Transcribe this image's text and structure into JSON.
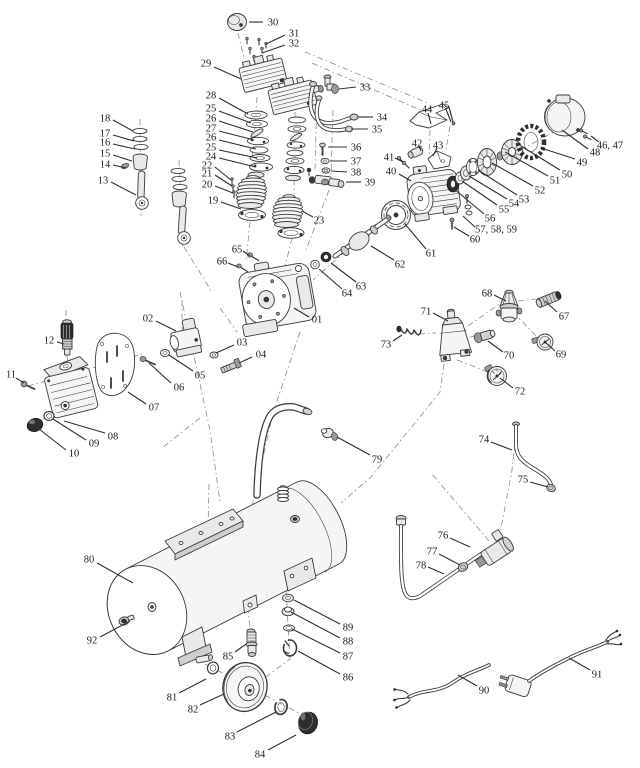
{
  "diagram": {
    "background": "#ffffff",
    "line_color": "#3a3a3a",
    "label_color": "#1b1b1b",
    "leader_color": "#2f2f2f",
    "dash_color": "#8a8a8a"
  },
  "callouts": [
    {
      "t": "01",
      "x": 317,
      "y": 319,
      "l": [
        309,
        317,
        294,
        308
      ]
    },
    {
      "t": "02",
      "x": 148,
      "y": 318,
      "l": [
        156,
        321,
        176,
        331
      ]
    },
    {
      "t": "03",
      "x": 242,
      "y": 342,
      "l": [
        234,
        345,
        216,
        353
      ]
    },
    {
      "t": "04",
      "x": 261,
      "y": 354,
      "l": [
        252,
        357,
        239,
        363
      ]
    },
    {
      "t": "05",
      "x": 200,
      "y": 375,
      "l": [
        193,
        371,
        169,
        355
      ]
    },
    {
      "t": "06",
      "x": 179,
      "y": 387,
      "l": [
        171,
        383,
        149,
        363
      ]
    },
    {
      "t": "07",
      "x": 154,
      "y": 407,
      "l": [
        146,
        404,
        128,
        392
      ]
    },
    {
      "t": "08",
      "x": 113,
      "y": 436,
      "l": [
        105,
        433,
        64,
        421
      ]
    },
    {
      "t": "09",
      "x": 94,
      "y": 443,
      "l": [
        86,
        440,
        53,
        419
      ]
    },
    {
      "t": "10",
      "x": 74,
      "y": 453,
      "l": [
        66,
        450,
        39,
        429
      ]
    },
    {
      "t": "11",
      "x": 11,
      "y": 374,
      "l": [
        16,
        378,
        24,
        383
      ]
    },
    {
      "t": "12",
      "x": 49,
      "y": 340,
      "l": [
        57,
        342,
        64,
        344
      ]
    },
    {
      "t": "13",
      "x": 103,
      "y": 180,
      "l": [
        111,
        182,
        136,
        195
      ]
    },
    {
      "t": "14",
      "x": 105,
      "y": 164,
      "l": [
        113,
        165,
        126,
        168
      ]
    },
    {
      "t": "15",
      "x": 105,
      "y": 153,
      "l": [
        113,
        155,
        132,
        161
      ]
    },
    {
      "t": "16",
      "x": 105,
      "y": 142,
      "l": [
        113,
        144,
        135,
        149
      ]
    },
    {
      "t": "17",
      "x": 105,
      "y": 133,
      "l": [
        113,
        135,
        134,
        141
      ]
    },
    {
      "t": "18",
      "x": 105,
      "y": 118,
      "l": [
        113,
        120,
        133,
        131
      ]
    },
    {
      "t": "19",
      "x": 213,
      "y": 200,
      "l": [
        221,
        202,
        241,
        209
      ]
    },
    {
      "t": "20",
      "x": 207,
      "y": 184,
      "l": [
        215,
        186,
        233,
        193
      ]
    },
    {
      "t": "21",
      "x": 207,
      "y": 173,
      "l": [
        215,
        175,
        232,
        186
      ]
    },
    {
      "t": "22",
      "x": 207,
      "y": 165,
      "l": [
        215,
        167,
        231,
        180
      ]
    },
    {
      "t": "23",
      "x": 319,
      "y": 220,
      "l": [
        313,
        217,
        302,
        211
      ]
    },
    {
      "t": "24",
      "x": 211,
      "y": 156,
      "l": [
        219,
        158,
        256,
        167
      ]
    },
    {
      "t": "25",
      "x": 211,
      "y": 108,
      "l": [
        219,
        111,
        251,
        123
      ]
    },
    {
      "t": "26",
      "x": 211,
      "y": 118,
      "l": [
        219,
        121,
        253,
        132
      ]
    },
    {
      "t": "27",
      "x": 211,
      "y": 128,
      "l": [
        219,
        131,
        254,
        140
      ]
    },
    {
      "t": "26",
      "x": 211,
      "y": 137,
      "l": [
        219,
        140,
        256,
        149
      ]
    },
    {
      "t": "25",
      "x": 211,
      "y": 147,
      "l": [
        219,
        150,
        257,
        158
      ]
    },
    {
      "t": "28",
      "x": 211,
      "y": 95,
      "l": [
        219,
        98,
        248,
        114
      ]
    },
    {
      "t": "29",
      "x": 206,
      "y": 63,
      "l": [
        214,
        67,
        241,
        79
      ]
    },
    {
      "t": "30",
      "x": 273,
      "y": 22,
      "l": [
        263,
        22,
        249,
        22
      ]
    },
    {
      "t": "31",
      "x": 294,
      "y": 33,
      "l": [
        285,
        35,
        266,
        44
      ]
    },
    {
      "t": "32",
      "x": 294,
      "y": 43,
      "l": [
        285,
        45,
        262,
        53
      ]
    },
    {
      "t": "33",
      "x": 365,
      "y": 87,
      "l": [
        356,
        87,
        339,
        89
      ]
    },
    {
      "t": "34",
      "x": 382,
      "y": 117,
      "l": [
        373,
        117,
        358,
        117
      ]
    },
    {
      "t": "35",
      "x": 377,
      "y": 129,
      "l": [
        368,
        129,
        351,
        129
      ]
    },
    {
      "t": "36",
      "x": 356,
      "y": 147,
      "l": [
        347,
        147,
        328,
        147
      ]
    },
    {
      "t": "37",
      "x": 356,
      "y": 161,
      "l": [
        347,
        161,
        330,
        161
      ]
    },
    {
      "t": "38",
      "x": 356,
      "y": 172,
      "l": [
        347,
        172,
        331,
        171
      ]
    },
    {
      "t": "39",
      "x": 370,
      "y": 182,
      "l": [
        361,
        182,
        346,
        182
      ]
    },
    {
      "t": "40",
      "x": 391,
      "y": 171,
      "l": [
        399,
        174,
        411,
        181
      ]
    },
    {
      "t": "41",
      "x": 389,
      "y": 157,
      "l": [
        395,
        158,
        403,
        162
      ]
    },
    {
      "t": "42",
      "x": 417,
      "y": 143,
      "l": [
        419,
        146,
        421,
        151
      ]
    },
    {
      "t": "43",
      "x": 438,
      "y": 145,
      "l": [
        437,
        148,
        433,
        156
      ]
    },
    {
      "t": "44",
      "x": 427,
      "y": 109,
      "l": [
        428,
        113,
        431,
        124
      ]
    },
    {
      "t": "45",
      "x": 444,
      "y": 105,
      "l": [
        446,
        109,
        451,
        122
      ]
    },
    {
      "t": "46, 47",
      "x": 610,
      "y": 145,
      "l": [
        599,
        142,
        591,
        136
      ]
    },
    {
      "t": "48",
      "x": 595,
      "y": 152,
      "l": [
        588,
        149,
        562,
        130
      ]
    },
    {
      "t": "49",
      "x": 582,
      "y": 162,
      "l": [
        575,
        159,
        541,
        148
      ]
    },
    {
      "t": "50",
      "x": 567,
      "y": 174,
      "l": [
        560,
        170,
        521,
        146
      ]
    },
    {
      "t": "51",
      "x": 555,
      "y": 180,
      "l": [
        548,
        176,
        505,
        152
      ]
    },
    {
      "t": "52",
      "x": 540,
      "y": 190,
      "l": [
        533,
        186,
        492,
        163
      ]
    },
    {
      "t": "53",
      "x": 524,
      "y": 199,
      "l": [
        517,
        195,
        478,
        170
      ]
    },
    {
      "t": "54",
      "x": 514,
      "y": 203,
      "l": [
        507,
        199,
        469,
        176
      ]
    },
    {
      "t": "55",
      "x": 504,
      "y": 209,
      "l": [
        497,
        205,
        462,
        181
      ]
    },
    {
      "t": "56",
      "x": 490,
      "y": 218,
      "l": [
        484,
        214,
        453,
        188
      ]
    },
    {
      "t": "57, 58, 59",
      "x": 496,
      "y": 229,
      "l": [
        475,
        227,
        463,
        216
      ]
    },
    {
      "t": "60",
      "x": 475,
      "y": 239,
      "l": [
        469,
        236,
        454,
        227
      ]
    },
    {
      "t": "61",
      "x": 431,
      "y": 253,
      "l": [
        426,
        249,
        405,
        224
      ]
    },
    {
      "t": "62",
      "x": 400,
      "y": 264,
      "l": [
        394,
        260,
        371,
        246
      ]
    },
    {
      "t": "63",
      "x": 361,
      "y": 286,
      "l": [
        356,
        282,
        331,
        263
      ]
    },
    {
      "t": "64",
      "x": 347,
      "y": 293,
      "l": [
        342,
        289,
        319,
        269
      ]
    },
    {
      "t": "65",
      "x": 237,
      "y": 249,
      "l": [
        243,
        251,
        250,
        256
      ]
    },
    {
      "t": "66",
      "x": 222,
      "y": 261,
      "l": [
        228,
        263,
        238,
        267
      ]
    },
    {
      "t": "67",
      "x": 564,
      "y": 316,
      "l": [
        557,
        312,
        545,
        301
      ]
    },
    {
      "t": "68",
      "x": 487,
      "y": 293,
      "l": [
        494,
        295,
        506,
        301
      ]
    },
    {
      "t": "69",
      "x": 561,
      "y": 354,
      "l": [
        555,
        351,
        545,
        342
      ]
    },
    {
      "t": "70",
      "x": 509,
      "y": 355,
      "l": [
        503,
        352,
        488,
        341
      ]
    },
    {
      "t": "71",
      "x": 426,
      "y": 311,
      "l": [
        433,
        313,
        448,
        321
      ]
    },
    {
      "t": "72",
      "x": 520,
      "y": 391,
      "l": [
        513,
        388,
        500,
        378
      ]
    },
    {
      "t": "73",
      "x": 386,
      "y": 344,
      "l": [
        393,
        341,
        402,
        335
      ]
    },
    {
      "t": "74",
      "x": 484,
      "y": 439,
      "l": [
        491,
        442,
        512,
        450
      ]
    },
    {
      "t": "75",
      "x": 523,
      "y": 479,
      "l": [
        530,
        482,
        548,
        487
      ]
    },
    {
      "t": "76",
      "x": 443,
      "y": 535,
      "l": [
        450,
        538,
        470,
        547
      ]
    },
    {
      "t": "77",
      "x": 432,
      "y": 551,
      "l": [
        439,
        554,
        460,
        565
      ]
    },
    {
      "t": "78",
      "x": 421,
      "y": 565,
      "l": [
        428,
        567,
        444,
        574
      ]
    },
    {
      "t": "79",
      "x": 377,
      "y": 459,
      "l": [
        370,
        455,
        337,
        437
      ]
    },
    {
      "t": "80",
      "x": 89,
      "y": 559,
      "l": [
        97,
        563,
        133,
        583
      ]
    },
    {
      "t": "81",
      "x": 172,
      "y": 697,
      "l": [
        179,
        693,
        206,
        679
      ]
    },
    {
      "t": "82",
      "x": 193,
      "y": 709,
      "l": [
        200,
        705,
        224,
        694
      ]
    },
    {
      "t": "83",
      "x": 230,
      "y": 736,
      "l": [
        237,
        732,
        276,
        712
      ]
    },
    {
      "t": "84",
      "x": 260,
      "y": 754,
      "l": [
        268,
        750,
        296,
        735
      ]
    },
    {
      "t": "85",
      "x": 228,
      "y": 656,
      "l": [
        235,
        652,
        246,
        644
      ]
    },
    {
      "t": "86",
      "x": 348,
      "y": 677,
      "l": [
        340,
        674,
        298,
        651
      ]
    },
    {
      "t": "87",
      "x": 348,
      "y": 656,
      "l": [
        340,
        653,
        292,
        629
      ]
    },
    {
      "t": "88",
      "x": 348,
      "y": 641,
      "l": [
        340,
        638,
        291,
        612
      ]
    },
    {
      "t": "89",
      "x": 348,
      "y": 627,
      "l": [
        340,
        624,
        294,
        600
      ]
    },
    {
      "t": "90",
      "x": 484,
      "y": 690,
      "l": [
        477,
        686,
        458,
        675
      ]
    },
    {
      "t": "91",
      "x": 597,
      "y": 674,
      "l": [
        590,
        670,
        569,
        658
      ]
    },
    {
      "t": "92",
      "x": 92,
      "y": 640,
      "l": [
        100,
        637,
        130,
        621
      ]
    }
  ]
}
